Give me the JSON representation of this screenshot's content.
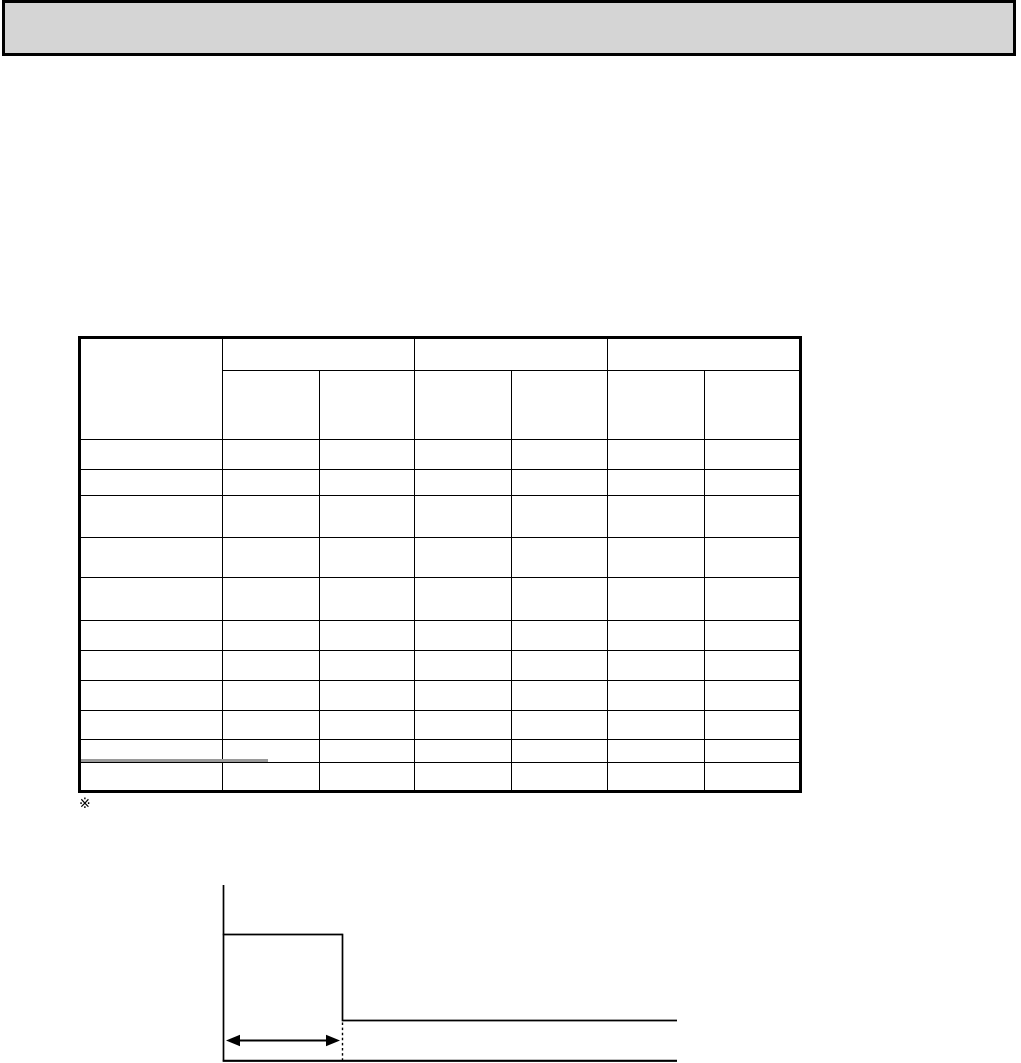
{
  "page": {
    "type": "scanned-document-page",
    "background": "#ffffff"
  },
  "header_bar": {
    "fill": "#d5d5d5",
    "border_color": "#000000",
    "text": ""
  },
  "table": {
    "border_color": "#000000",
    "faded_border_color": "#9a9a9a",
    "column_count": 7,
    "data_row_count": 11,
    "all_cells_empty": true,
    "header": {
      "corner": "",
      "groups": [
        "",
        "",
        ""
      ],
      "subcolumns": [
        "",
        "",
        "",
        "",
        "",
        ""
      ]
    }
  },
  "note": {
    "marker": "※"
  },
  "diagram": {
    "name": "pulse-width-timing-diagram",
    "line_color": "#000000",
    "labels": []
  }
}
